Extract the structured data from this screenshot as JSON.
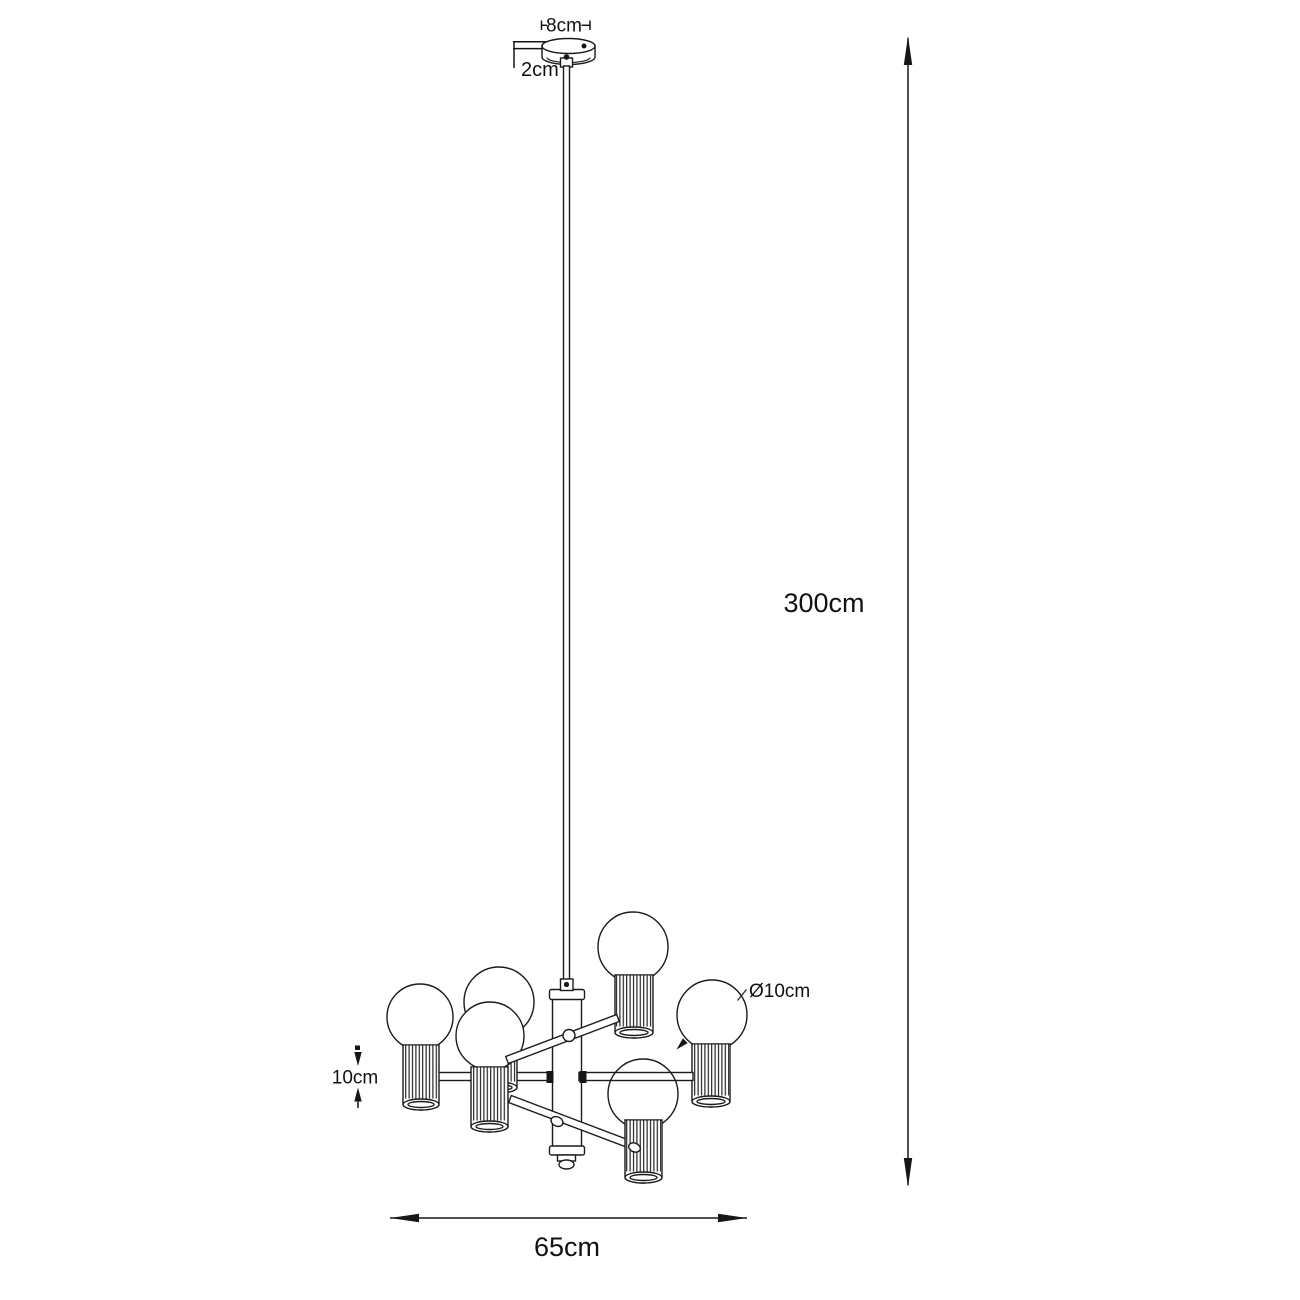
{
  "diagram": {
    "type": "pendant-lamp-dimension-drawing",
    "bulb_count": 6,
    "colors": {
      "line": "#1b1b1b",
      "background": "#ffffff"
    },
    "dimensions": {
      "canopy_diameter": "8cm",
      "canopy_height": "2cm",
      "suspension_length": "300cm",
      "bulb_diameter": "Ø10cm",
      "shade_height": "10cm",
      "fixture_width": "65cm"
    }
  }
}
